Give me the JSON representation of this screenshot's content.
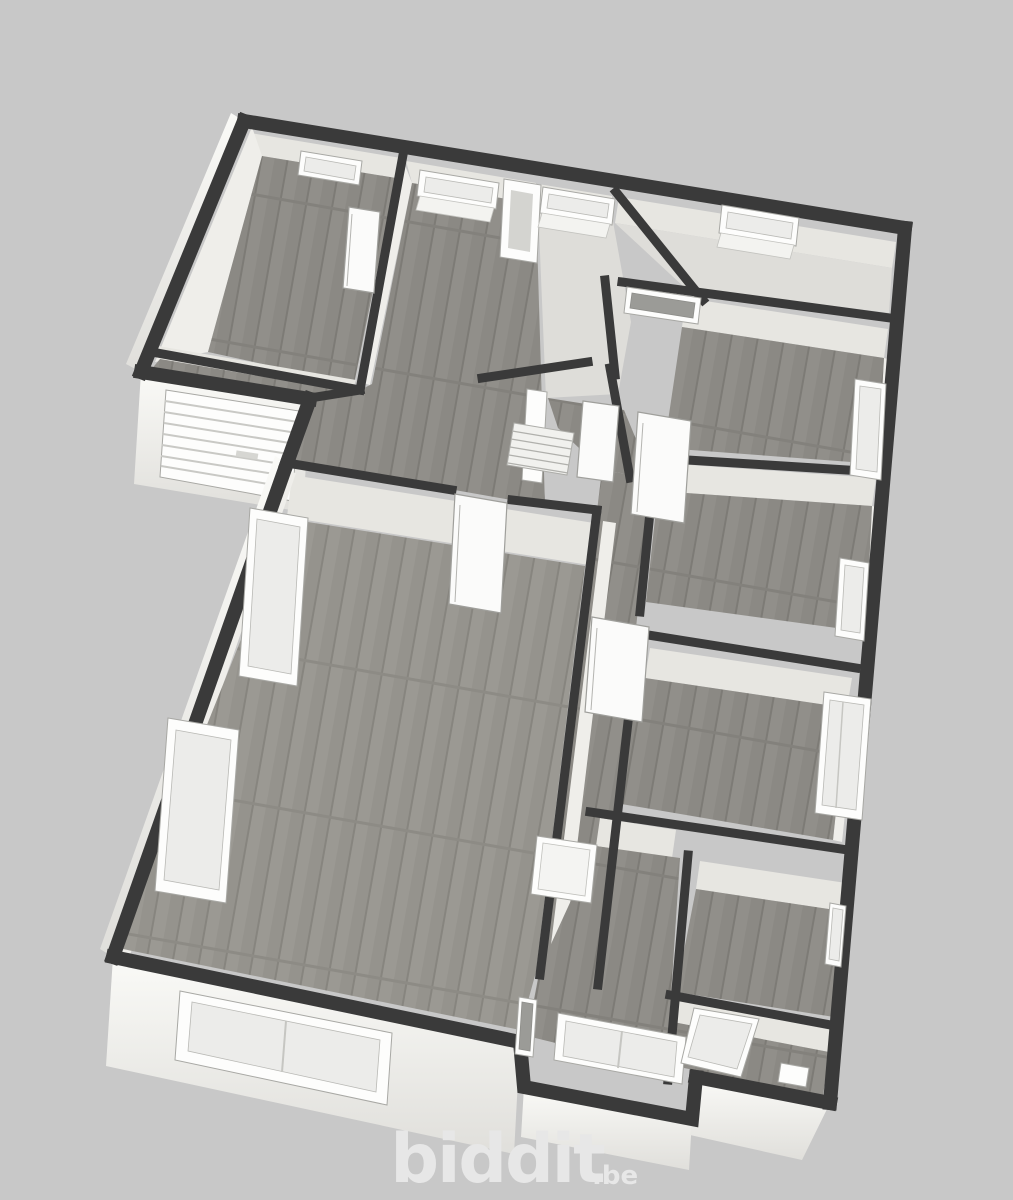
{
  "branding": {
    "logo": "biddit",
    "logo_suffix": ".be"
  },
  "palette": {
    "background": "#c8c8c8",
    "wall_top": "#3a3a3a",
    "wall_face": "#e7e6e1",
    "wall_exterior": "#f7f7f4",
    "floor_wood": "#8b8984",
    "floor_wood_light": "#95938d",
    "floor_tile": "#deddd9",
    "window_frame": "#fdfdfc",
    "frame_outline": "#a8a8a4",
    "glass_dark": "#9b9b97",
    "glass_light": "#ececea",
    "logo_color": "#e7e7e7"
  }
}
